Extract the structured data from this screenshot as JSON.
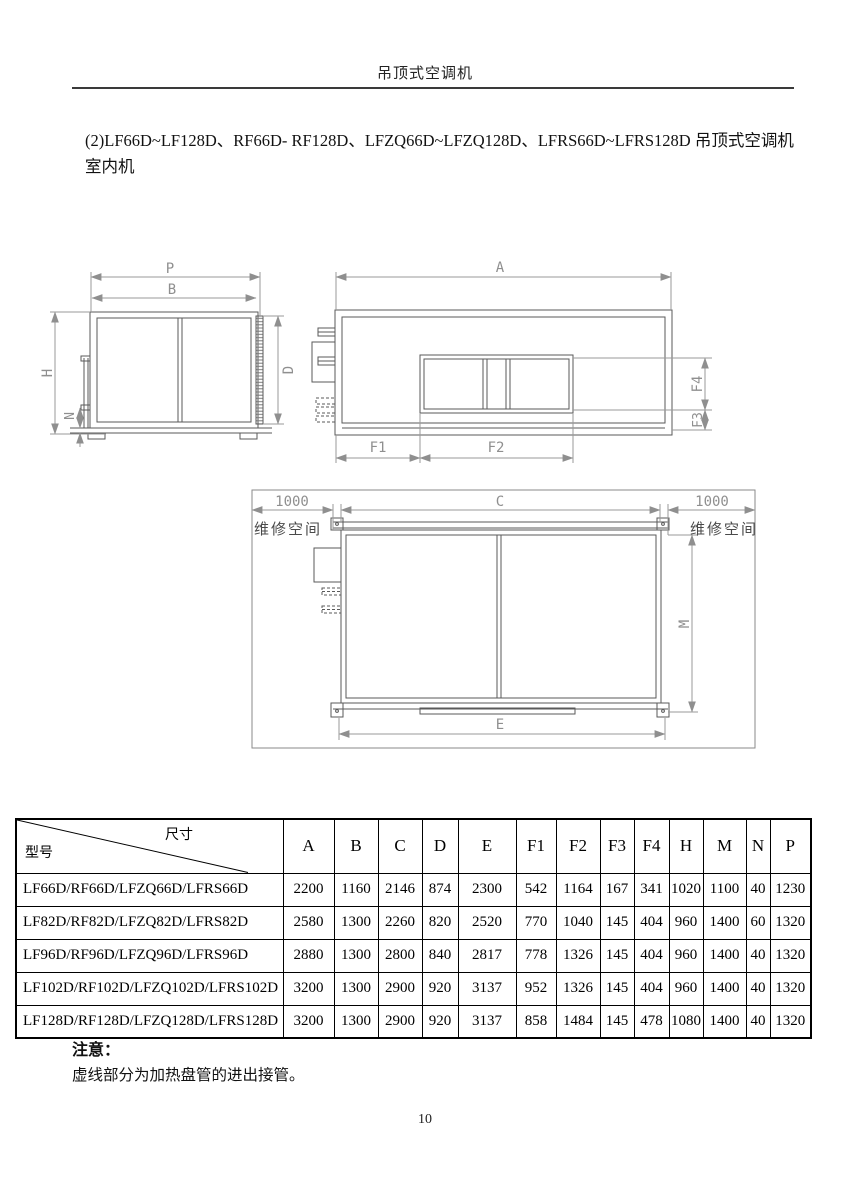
{
  "page": {
    "header_title": "吊顶式空调机",
    "intro": "(2)LF66D~LF128D、RF66D- RF128D、LFZQ66D~LFZQ128D、LFRS66D~LFRS128D 吊顶式空调机室内机",
    "page_number": "10"
  },
  "diagram": {
    "labels": {
      "p": "P",
      "b": "B",
      "h": "H",
      "d": "D",
      "n": "N",
      "a": "A",
      "f1": "F1",
      "f2": "F2",
      "f3": "F3",
      "f4": "F4",
      "c": "C",
      "e": "E",
      "m": "M",
      "service_gap": "1000",
      "service_space": "维修空间"
    },
    "line_color": "#5a5a5a",
    "dim_color": "#9a9a9a"
  },
  "table": {
    "corner": {
      "top": "尺寸",
      "bottom": "型号"
    },
    "columns": [
      "A",
      "B",
      "C",
      "D",
      "E",
      "F1",
      "F2",
      "F3",
      "F4",
      "H",
      "M",
      "N",
      "P"
    ],
    "rows": [
      {
        "model": "LF66D/RF66D/LFZQ66D/LFRS66D",
        "values": [
          "2200",
          "1160",
          "2146",
          "874",
          "2300",
          "542",
          "1164",
          "167",
          "341",
          "1020",
          "1100",
          "40",
          "1230"
        ]
      },
      {
        "model": "LF82D/RF82D/LFZQ82D/LFRS82D",
        "values": [
          "2580",
          "1300",
          "2260",
          "820",
          "2520",
          "770",
          "1040",
          "145",
          "404",
          "960",
          "1400",
          "60",
          "1320"
        ]
      },
      {
        "model": "LF96D/RF96D/LFZQ96D/LFRS96D",
        "values": [
          "2880",
          "1300",
          "2800",
          "840",
          "2817",
          "778",
          "1326",
          "145",
          "404",
          "960",
          "1400",
          "40",
          "1320"
        ]
      },
      {
        "model": "LF102D/RF102D/LFZQ102D/LFRS102D",
        "values": [
          "3200",
          "1300",
          "2900",
          "920",
          "3137",
          "952",
          "1326",
          "145",
          "404",
          "960",
          "1400",
          "40",
          "1320"
        ]
      },
      {
        "model": "LF128D/RF128D/LFZQ128D/LFRS128D",
        "values": [
          "3200",
          "1300",
          "2900",
          "920",
          "3137",
          "858",
          "1484",
          "145",
          "478",
          "1080",
          "1400",
          "40",
          "1320"
        ]
      }
    ]
  },
  "notes": {
    "title": "注意：",
    "body": "虚线部分为加热盘管的进出接管。"
  }
}
